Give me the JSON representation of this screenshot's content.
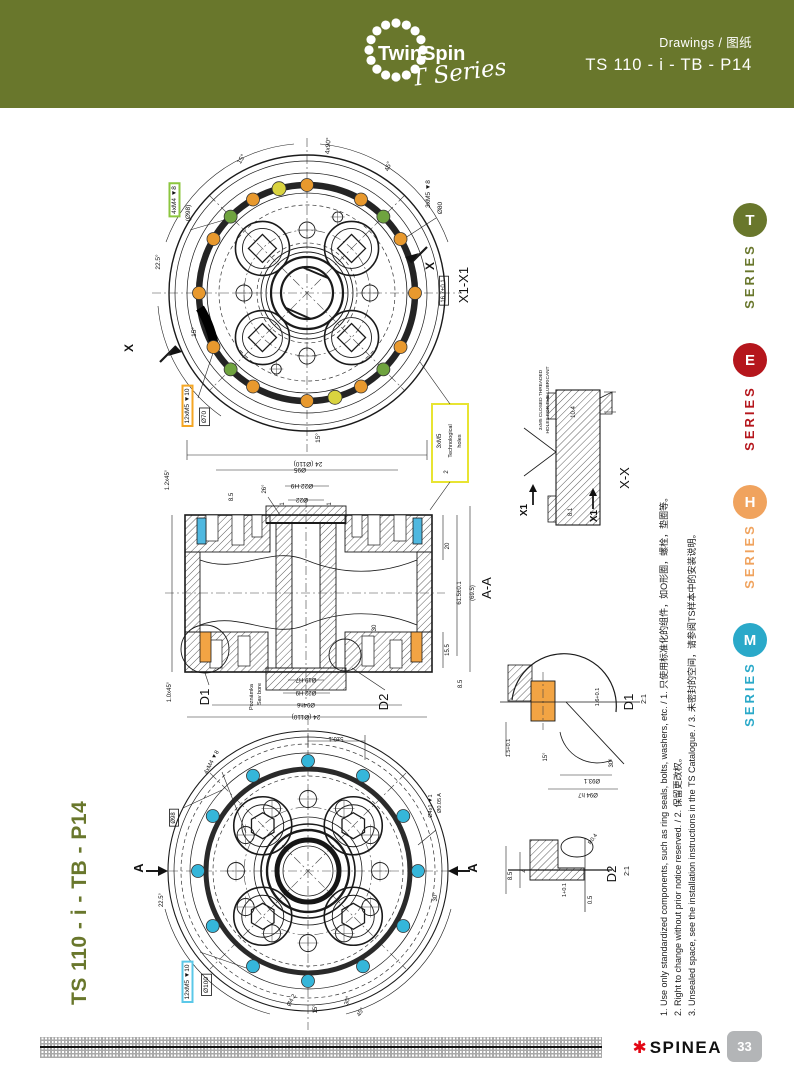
{
  "colors": {
    "olive": "#69772C",
    "series_red": "#B5161C",
    "series_orange": "#F0A35E",
    "series_teal": "#2AA9C9",
    "spinea_red": "#E30613",
    "tab_gray": "#B3B5B7",
    "seal_blue": "#4FB8E0",
    "seal_orange": "#F2A444",
    "dot_orange": "#E8992E",
    "dot_green": "#6FA33F",
    "dot_yellow": "#D9D33F",
    "dot_cyan": "#35B6DA",
    "box_green": "#8CC63F",
    "box_orange": "#F5A623",
    "box_yellow": "#E8E432",
    "box_cyan": "#5BC8E8"
  },
  "header": {
    "logo_title": "TwinSpin",
    "logo_subtitle": "T Series",
    "doc_type": "Drawings / 图纸",
    "doc_code": "TS 110 - i - TB - P14"
  },
  "series_rail": {
    "items": [
      {
        "letter": "T",
        "label": "SERIES",
        "color": "#69772C"
      },
      {
        "letter": "E",
        "label": "SERIES",
        "color": "#B5161C"
      },
      {
        "letter": "H",
        "label": "SERIES",
        "color": "#F0A35E"
      },
      {
        "letter": "M",
        "label": "SERIES",
        "color": "#2AA9C9"
      }
    ]
  },
  "side_title": "TS 110 - i - TB - P14",
  "footnotes": [
    "1. Use only standardized components, such as ring seals, bolts, washers, etc. / 1. 只使用标准化的组件，如O形圈，螺栓，垫圈等。",
    "2. Right to change without prior notice reserved. / 2. 保留更改权。",
    "3. Unsealed space, see the installation instructions in the TS Catalogue. / 3. 未密封的空间，请参阅TS样本中的安装说明。"
  ],
  "footer": {
    "brand": "SPINEA",
    "brand_mark": "✱",
    "page_number": "33"
  },
  "logo": {
    "dots": {
      "cx": 40,
      "cy": 42,
      "r": 27,
      "count": 16,
      "dot_r": 4.6
    }
  },
  "drawings": {
    "labels": [
      {
        "t": "4xM4 ▼8",
        "x": 176,
        "y": 200,
        "r": -90,
        "s": 6.5,
        "b": "#8CC63F"
      },
      {
        "t": "(Ø98)",
        "x": 190,
        "y": 213,
        "r": -90,
        "s": 6.5
      },
      {
        "t": "12xM5 ▼10",
        "x": 189,
        "y": 406,
        "r": -90,
        "s": 6.5,
        "b": "#F5A623"
      },
      {
        "t": "Ø70",
        "x": 206,
        "y": 417,
        "r": -90,
        "s": 6.5,
        "b": "#111"
      },
      {
        "t": "3xM5 ▼8",
        "x": 430,
        "y": 194,
        "r": -90,
        "s": 6.5
      },
      {
        "t": "Ø80",
        "x": 442,
        "y": 208,
        "r": -90,
        "s": 6.5
      },
      {
        "t": "X",
        "x": 434,
        "y": 266,
        "r": -90,
        "s": 12,
        "w": 1
      },
      {
        "t": "X",
        "x": 133,
        "y": 348,
        "r": -90,
        "s": 12,
        "w": 1
      },
      {
        "t": "X1-X1",
        "x": 468,
        "y": 285,
        "r": -90,
        "s": 13
      },
      {
        "t": "16.7±0.1",
        "x": 445,
        "y": 291,
        "r": -90,
        "s": 6,
        "b": "#111"
      },
      {
        "t": "15°",
        "x": 243,
        "y": 160,
        "r": -60,
        "s": 6.5
      },
      {
        "t": "4x90°",
        "x": 330,
        "y": 146,
        "r": -85,
        "s": 6.5
      },
      {
        "t": "45°",
        "x": 390,
        "y": 167,
        "r": -72,
        "s": 6.5
      },
      {
        "t": "22.5°",
        "x": 160,
        "y": 262,
        "r": -90,
        "s": 6.5
      },
      {
        "t": "15°",
        "x": 196,
        "y": 332,
        "r": -90,
        "s": 6.5
      },
      {
        "t": "15°",
        "x": 320,
        "y": 438,
        "r": -90,
        "s": 6.5
      },
      {
        "t": "24 (Ø110)",
        "x": 308,
        "y": 462,
        "r": 180,
        "s": 6.5
      },
      {
        "t": "3xM5",
        "x": 441,
        "y": 441,
        "r": -90,
        "s": 6
      },
      {
        "t": "Technological",
        "x": 452,
        "y": 441,
        "r": -90,
        "s": 5.5
      },
      {
        "t": "holes",
        "x": 461,
        "y": 441,
        "r": -90,
        "s": 5.5
      },
      {
        "t": "1.2x45°",
        "x": 169,
        "y": 480,
        "r": -90,
        "s": 6
      },
      {
        "t": "1.0x45°",
        "x": 171,
        "y": 692,
        "r": -90,
        "s": 6
      },
      {
        "t": "8.5",
        "x": 233,
        "y": 497,
        "r": -90,
        "s": 6
      },
      {
        "t": "26°",
        "x": 266,
        "y": 489,
        "r": -90,
        "s": 6
      },
      {
        "t": "1",
        "x": 284,
        "y": 504,
        "r": -90,
        "s": 6
      },
      {
        "t": "1",
        "x": 331,
        "y": 504,
        "r": -90,
        "s": 6
      },
      {
        "t": "Ø95",
        "x": 300,
        "y": 468,
        "r": 180,
        "s": 6.5
      },
      {
        "t": "Ø22 H9",
        "x": 302,
        "y": 484,
        "r": 180,
        "s": 6.5
      },
      {
        "t": "Ø22",
        "x": 302,
        "y": 498,
        "r": 180,
        "s": 6.5
      },
      {
        "t": "2",
        "x": 448,
        "y": 472,
        "r": -90,
        "s": 6
      },
      {
        "t": "20",
        "x": 449,
        "y": 546,
        "r": -90,
        "s": 6
      },
      {
        "t": "61.5±0.1",
        "x": 461,
        "y": 593,
        "r": -90,
        "s": 6
      },
      {
        "t": "(69.5)",
        "x": 474,
        "y": 593,
        "r": -90,
        "s": 6
      },
      {
        "t": "15.5",
        "x": 449,
        "y": 650,
        "r": -90,
        "s": 6
      },
      {
        "t": "8.5",
        "x": 462,
        "y": 684,
        "r": -90,
        "s": 6
      },
      {
        "t": "30",
        "x": 376,
        "y": 628,
        "r": -90,
        "s": 6
      },
      {
        "t": "A-A",
        "x": 491,
        "y": 588,
        "r": -90,
        "s": 13
      },
      {
        "t": "D1",
        "x": 209,
        "y": 697,
        "r": -90,
        "s": 13
      },
      {
        "t": "D2",
        "x": 388,
        "y": 702,
        "r": -90,
        "s": 13
      },
      {
        "t": "Poznámka",
        "x": 253,
        "y": 697,
        "r": -90,
        "s": 5.5
      },
      {
        "t": "Sav bore",
        "x": 261,
        "y": 694,
        "r": -90,
        "s": 5.5
      },
      {
        "t": "Ø19 H7",
        "x": 306,
        "y": 678,
        "r": 180,
        "s": 6
      },
      {
        "t": "Ø22 H9",
        "x": 306,
        "y": 691,
        "r": 180,
        "s": 6
      },
      {
        "t": "Ø94h6",
        "x": 306,
        "y": 703,
        "r": 180,
        "s": 6
      },
      {
        "t": "24 (Ø110)",
        "x": 306,
        "y": 715,
        "r": 180,
        "s": 6.5
      },
      {
        "t": "3xM5 CLOSED THREADED",
        "x": 542,
        "y": 400,
        "r": -90,
        "s": 4.8
      },
      {
        "t": "HOLES FOR THE LUBRICANT",
        "x": 549,
        "y": 400,
        "r": -90,
        "s": 4.8
      },
      {
        "t": "10.4",
        "x": 575,
        "y": 412,
        "r": -90,
        "s": 6
      },
      {
        "t": "8.1",
        "x": 572,
        "y": 512,
        "r": -90,
        "s": 6
      },
      {
        "t": "X1",
        "x": 527,
        "y": 510,
        "r": -90,
        "s": 10,
        "w": 1
      },
      {
        "t": "X1",
        "x": 597,
        "y": 516,
        "r": -90,
        "s": 10,
        "w": 1
      },
      {
        "t": "X-X",
        "x": 629,
        "y": 478,
        "r": -90,
        "s": 13
      },
      {
        "t": "D1",
        "x": 633,
        "y": 702,
        "r": -90,
        "s": 13
      },
      {
        "t": "2:1",
        "x": 646,
        "y": 699,
        "r": -90,
        "s": 7
      },
      {
        "t": "1.5+0.1",
        "x": 510,
        "y": 748,
        "r": -90,
        "s": 5.5
      },
      {
        "t": "1.6+0.1",
        "x": 599,
        "y": 697,
        "r": -90,
        "s": 5.5
      },
      {
        "t": "30°",
        "x": 613,
        "y": 763,
        "r": -90,
        "s": 6
      },
      {
        "t": "15°",
        "x": 547,
        "y": 757,
        "r": -90,
        "s": 6
      },
      {
        "t": "Ø93.1",
        "x": 592,
        "y": 779,
        "r": 180,
        "s": 6
      },
      {
        "t": "Ø94 h7",
        "x": 588,
        "y": 793,
        "r": 180,
        "s": 6
      },
      {
        "t": "D2",
        "x": 616,
        "y": 874,
        "r": -90,
        "s": 13
      },
      {
        "t": "2:1",
        "x": 629,
        "y": 871,
        "r": -90,
        "s": 7
      },
      {
        "t": "8.5",
        "x": 512,
        "y": 876,
        "r": -90,
        "s": 6
      },
      {
        "t": "4",
        "x": 526,
        "y": 871,
        "r": -90,
        "s": 6
      },
      {
        "t": "R0.4",
        "x": 594,
        "y": 840,
        "r": -55,
        "s": 5.5
      },
      {
        "t": "1+0.1",
        "x": 566,
        "y": 890,
        "r": -90,
        "s": 5.5
      },
      {
        "t": "0.5",
        "x": 592,
        "y": 900,
        "r": -90,
        "s": 6
      },
      {
        "t": "12xM5 ▼10",
        "x": 189,
        "y": 982,
        "r": -90,
        "s": 6.5,
        "b": "#5BC8E8"
      },
      {
        "t": "Ø100",
        "x": 208,
        "y": 985,
        "r": -90,
        "s": 6.5,
        "b": "#111"
      },
      {
        "t": "4xM4 ▼8",
        "x": 213,
        "y": 763,
        "r": -62,
        "s": 6
      },
      {
        "t": "Ø98",
        "x": 175,
        "y": 818,
        "r": -90,
        "s": 6,
        "b": "#111"
      },
      {
        "t": "Ø4x1 ▼1",
        "x": 432,
        "y": 806,
        "r": -90,
        "s": 5.5
      },
      {
        "t": "Ø0.05 A",
        "x": 441,
        "y": 803,
        "r": -90,
        "s": 5.5
      },
      {
        "t": "A",
        "x": 477,
        "y": 868,
        "r": -90,
        "s": 13,
        "w": 1
      },
      {
        "t": "A",
        "x": 143,
        "y": 868,
        "r": -90,
        "s": 13,
        "w": 1
      },
      {
        "t": "30°",
        "x": 437,
        "y": 897,
        "r": -90,
        "s": 6
      },
      {
        "t": "22.5°",
        "x": 163,
        "y": 900,
        "r": -90,
        "s": 6
      },
      {
        "t": "15°",
        "x": 317,
        "y": 1009,
        "r": -90,
        "s": 6
      },
      {
        "t": "30°",
        "x": 349,
        "y": 1001,
        "r": -75,
        "s": 6
      },
      {
        "t": "45°",
        "x": 362,
        "y": 1013,
        "r": -60,
        "s": 6
      },
      {
        "t": "Ø4.2",
        "x": 293,
        "y": 1001,
        "r": -62,
        "s": 6
      },
      {
        "t": "5±0.1",
        "x": 336,
        "y": 737,
        "r": 180,
        "s": 6
      }
    ],
    "dot_groups": [
      {
        "layer": "top-dots",
        "cx": 307,
        "cy": 293,
        "ring": 108,
        "dr": 6.5,
        "color": "#E8992E",
        "angles": [
          0,
          30,
          60,
          90,
          120,
          150,
          180,
          210,
          240,
          270,
          300,
          330
        ]
      },
      {
        "layer": "top-dots",
        "cx": 307,
        "cy": 293,
        "ring": 108,
        "dr": 6.5,
        "color": "#6FA33F",
        "angles": [
          45,
          135,
          225,
          315
        ]
      },
      {
        "layer": "top-dots",
        "cx": 307,
        "cy": 293,
        "ring": 108,
        "dr": 7,
        "color": "#D9D33F",
        "angles": [
          105,
          285
        ]
      },
      {
        "layer": "bot-dots",
        "cx": 308,
        "cy": 871,
        "ring": 110,
        "dr": 6.5,
        "color": "#35B6DA",
        "angles": [
          0,
          30,
          60,
          90,
          120,
          150,
          180,
          210,
          240,
          270,
          300,
          330
        ]
      }
    ],
    "bolt_holes": [
      {
        "layer": "top-holes",
        "cx": 307,
        "cy": 293,
        "dist": 63,
        "angles": [
          45,
          135,
          225,
          315
        ],
        "outer": 27,
        "mid": 20,
        "shape": "diamond",
        "half": 14
      },
      {
        "layer": "bot-holes",
        "cx": 308,
        "cy": 871,
        "dist": 64,
        "angles": [
          45,
          135,
          225,
          315
        ],
        "outer": 29,
        "mid": 21,
        "shape": "hex",
        "half": 13
      }
    ],
    "circle_rings": [
      {
        "layer": "top-rings",
        "cx": 307,
        "cy": 293,
        "dist": 63,
        "r": 8,
        "angles": [
          0,
          90,
          180,
          270
        ]
      },
      {
        "layer": "top-rings",
        "cx": 307,
        "cy": 293,
        "dist": 82,
        "r": 5,
        "angles": [
          68,
          248
        ]
      },
      {
        "layer": "bot-rings",
        "cx": 308,
        "cy": 871,
        "dist": 72,
        "r": 8.5,
        "angles": [
          0,
          30,
          60,
          90,
          120,
          150,
          180,
          210,
          240,
          270,
          300,
          330
        ]
      }
    ]
  }
}
